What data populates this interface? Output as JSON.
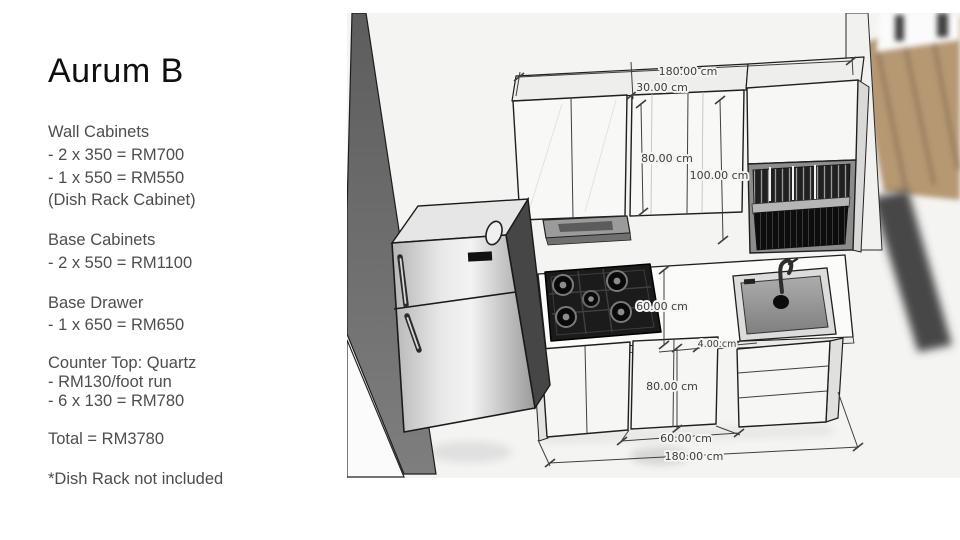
{
  "quote_panel": {
    "title": "Aurum B",
    "sections": [
      {
        "heading": "Wall Cabinets",
        "lines": [
          "- 2 x 350 = RM700",
          "- 1 x 550 = RM550",
          "(Dish Rack Cabinet)"
        ]
      },
      {
        "heading": "Base Cabinets",
        "lines": [
          "- 2 x 550 = RM1100"
        ]
      },
      {
        "heading": "Base Drawer",
        "lines": [
          "- 1 x 650 = RM650"
        ]
      },
      {
        "heading": "Counter Top: Quartz",
        "lines": [
          "- RM130/foot run",
          "- 6 x 130 = RM780"
        ]
      },
      {
        "heading": "Total = RM3780",
        "lines": []
      },
      {
        "heading": "*Dish Rack not included",
        "lines": []
      }
    ]
  },
  "render_3d": {
    "dimension_labels": {
      "overall_width_top": "180.00 cm",
      "wall_cabinet_depth": "30.00 cm",
      "wall_cabinet_height": "80.00 cm",
      "dish_rack_cabinet_height": "100.00 cm",
      "counter_to_cabinet_gap": "60.00 cm",
      "countertop_thickness": "4.00 cm",
      "base_cabinet_height": "80.00 cm",
      "middle_cabinet_width": "60.00 cm",
      "overall_width_bottom": "180.00 cm"
    },
    "colors": {
      "render_background": "#f4f4f3",
      "partition_wall_gray": "#6a6a6a",
      "wood_floor": "#b69873",
      "dimension_text": "#3c3c3c",
      "cooktop_black": "#1b1b1b"
    }
  }
}
